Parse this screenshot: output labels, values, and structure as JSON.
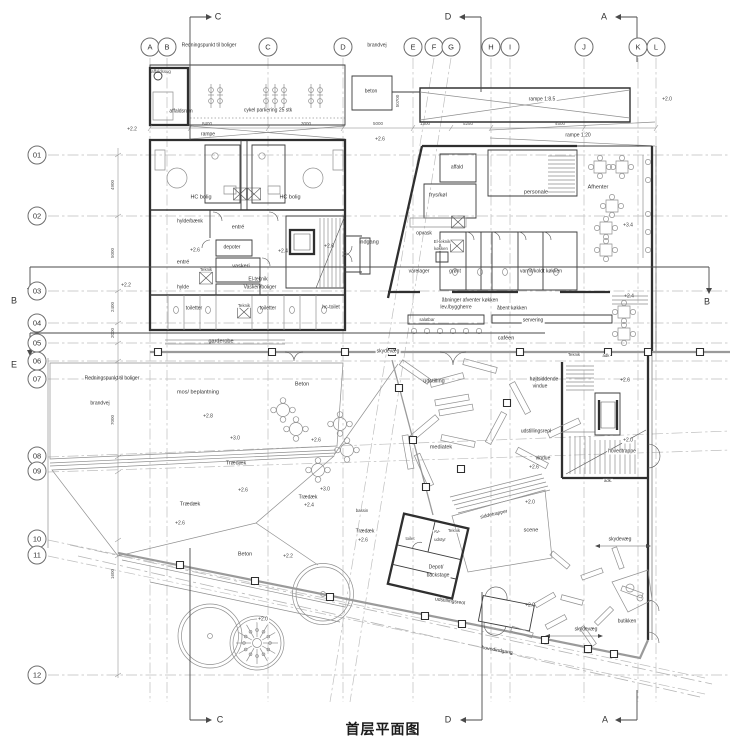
{
  "title": "首层平面图",
  "grid": {
    "columns": [
      "A",
      "B",
      "C",
      "D",
      "E",
      "F",
      "G",
      "H",
      "I",
      "J",
      "K",
      "L"
    ],
    "rows": [
      "01",
      "02",
      "03",
      "04",
      "05",
      "06",
      "07",
      "08",
      "09",
      "10",
      "11",
      "12"
    ]
  },
  "sections": {
    "top_c": "C",
    "top_d": "D",
    "top_a": "A",
    "bottom_c": "C",
    "bottom_d": "D",
    "bottom_a": "A",
    "left_b": "B",
    "left_e": "E",
    "right_b": "B"
  },
  "labels": {
    "redningspunkt_top": "Redningspunkt til boliger",
    "brandvej_top": "brandvej",
    "affaldssug": "affaldssug",
    "affaldsrum": "affaldsrum",
    "cykel_parkering": "cykel parkering 25 stk",
    "beton_small": "beton",
    "rampe": "rampe",
    "lvl_22_rampe": "+2.2",
    "rampe_1_85": "rampe 1:8.5",
    "lvl_20_rampe": "+2.0",
    "rampe_1_20": "rampe 1:20",
    "lvl_26_g": "+2.6",
    "hc_bolig_1": "HC bolig",
    "hc_bolig_2": "HC bolig",
    "hylde_baenk": "hylde/bænk",
    "entre_1": "entré",
    "entre_2": "entré",
    "lvl_26_entre": "+2.6",
    "depoter": "depoter",
    "vaskeri": "vaskeri",
    "lvl_24_res": "+2.4",
    "lvl_26_ind": "+2.6",
    "indgang": "indgang",
    "teknik_1": "Teknik",
    "teknik_2": "Teknik",
    "el_teknik_1": "El-teknik",
    "el_teknik_2": "Vaskeri/boliger",
    "hylde": "hylde",
    "lvl_22_left": "+2.2",
    "toiletter_1": "toiletter",
    "toiletter_2": "toiletter",
    "hc_toilet": "hc-toilet",
    "garderobe": "garderobe",
    "affald": "affald",
    "frys_koel": "frys/køl",
    "personale": "personale",
    "afhenter": "Afhenter",
    "opvask": "opvask",
    "el_teknik_k1": "El-teknik",
    "el_teknik_k2": "køkken",
    "varelager": "varelager",
    "groent": "grønt",
    "varmt_koldt": "varmt/koldt køkken",
    "aabninger_1": "åbninger afventer køkken",
    "aabninger_2": "lev./byggherre",
    "aabent_koekken": "åbent køkken",
    "salatbar": "salatbar",
    "servering": "servering",
    "cafeen": "caféen",
    "lvl_34_cafe": "+3.4",
    "lvl_24_cafe": "+2.4",
    "skydevaeg_1": "skydevæg",
    "skydevaeg_2": "skydevæg",
    "skydevaeg_3": "skydevæg",
    "teknik_3": "Teknik",
    "adk_1": "adk",
    "udstilling": "udstilling",
    "hoejtsiddende": "højtsiddende",
    "vindue_1": "vindue",
    "lvl_26_k": "+2.6",
    "udstillingsreol_1": "udstillingsreol",
    "udstillingsreol_2": "udstillingsreol",
    "mediatek": "mediatek",
    "vindue_2": "vindue",
    "lvl_26_vindue": "+2.6",
    "hovedtrappe": "hovedtrappe",
    "lvl_20_trappe": "+2.0",
    "adk_2": "adk.",
    "lvl_20_scene": "+2.0",
    "scene": "scene",
    "siddetrapper": "siddetrapper",
    "toilet": "toilet",
    "av_1": "AV-",
    "av_2": "udstyr",
    "teknik_4": "Teknik",
    "depot_1": "Depot/",
    "depot_2": "backstage",
    "lvl_20_ind": "+2.0",
    "hovedindgang": "hovedindgang",
    "butikken": "butikken",
    "mos_beplantning": "mos/ beplantning",
    "lvl_28": "+2.8",
    "beton_1": "Beton",
    "beton_2": "Beton",
    "lvl_30_1": "+3.0",
    "lvl_26_c1": "+2.6",
    "traedaek_1": "Trædæk",
    "traedaek_2": "Trædæk",
    "traedaek_3": "Trædæk",
    "traedaek_4": "Trædæk",
    "lvl_26_t1": "+2.6",
    "lvl_26_t2": "+2.6",
    "lvl_26_t4": "+2.6",
    "lvl_24_t3": "+2.4",
    "lvl_30_2": "+3.0",
    "bassin": "bassin",
    "lvl_22_sw": "+2.2",
    "lvl_20_tree": "+2.0",
    "redningspunkt_left": "Redningspunkt til boliger",
    "brandvej_left": "brandvej"
  },
  "dims": {
    "t1": "8400",
    "t2": "3000",
    "t3": "5000",
    "t4": "1300",
    "t5": "5250",
    "t6": "4500",
    "v1": "4900",
    "v2": "5000",
    "v3": "2400",
    "v4": "2000",
    "v5": "7000",
    "v6": "1600",
    "ramp": "50700"
  }
}
